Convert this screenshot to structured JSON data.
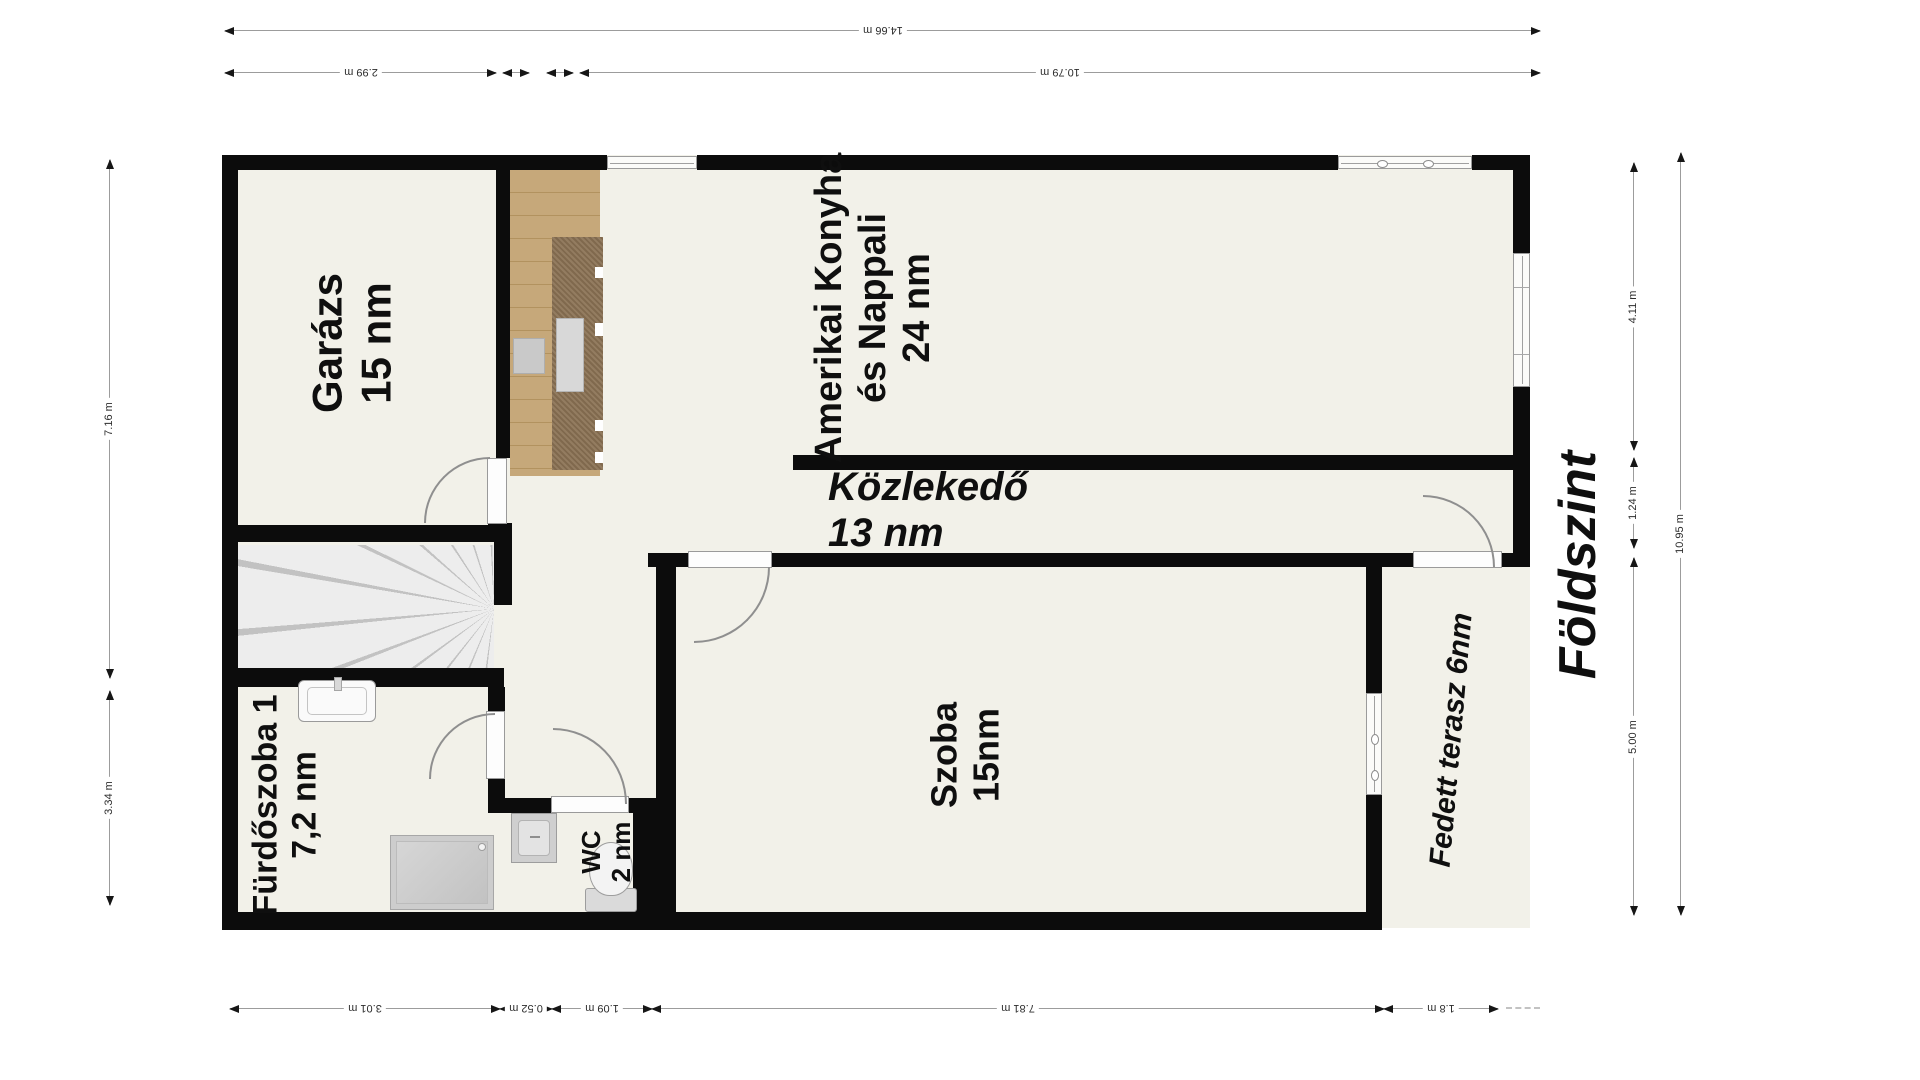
{
  "floor_title": "Földszint",
  "rooms": {
    "garage": {
      "name": "Garázs",
      "area": "15 nm"
    },
    "living": {
      "name_line1": "Amerikai Konyha",
      "name_line2": "és Nappali",
      "area": "24 nm"
    },
    "hall": {
      "name": "Közlekedő",
      "area": "13 nm"
    },
    "bedroom": {
      "name": "Szoba",
      "area": "15nm"
    },
    "bathroom": {
      "name": "Fürdőszoba 1",
      "area": "7,2 nm"
    },
    "wc": {
      "name": "WC",
      "area": "2 nm"
    },
    "terrace": {
      "name": "Fedett terasz 6nm"
    }
  },
  "dimensions": {
    "top_total": "14.66 m",
    "top_garage": "2.99 m",
    "top_living": "10.79 m",
    "left_upper": "7.16 m",
    "left_lower": "3.34 m",
    "right_upper": "4.11 m",
    "right_middle": "1.24 m",
    "right_lower": "5.00 m",
    "right_total": "10.95 m",
    "bottom": [
      "3.01 m",
      "0.52 m",
      "1.09 m",
      "7.81 m",
      "1.8 m"
    ]
  },
  "colors": {
    "wall": "#0c0c0c",
    "floor": "#f2f1e9",
    "wood_floor": "#c3a376",
    "kitchen_counter": "#8b7254",
    "fixture_gray": "#cfcfcf",
    "dimension_line": "#9c9c9c"
  }
}
